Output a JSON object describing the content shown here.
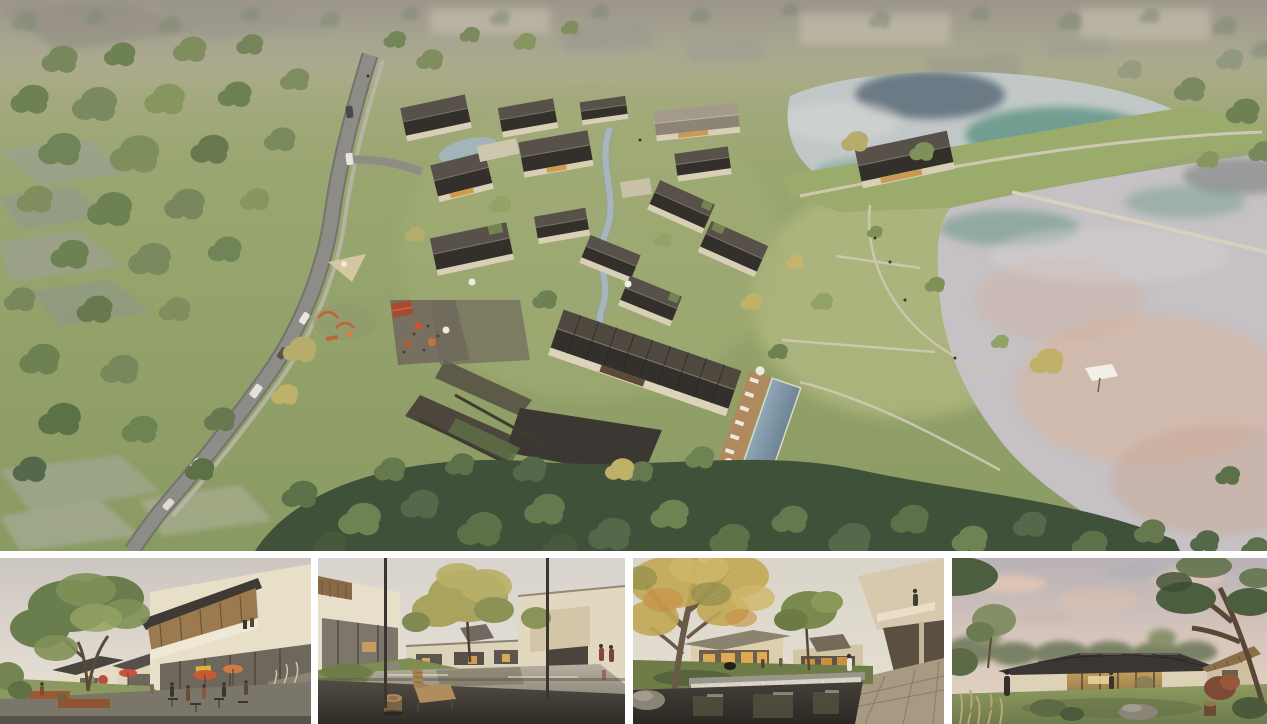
{
  "board": {
    "kind": "architectural rendering presentation board",
    "background_color": "#ffffff",
    "text_visible": "none"
  },
  "aerial_view": {
    "description": "Bird's-eye rendering of a courtyard-house resort village beside two ponds, with a curved access road, meadows, dense tree belts and hazy fields at the horizon",
    "features": {
      "road": "curved grey access road with cars and a sidewalk",
      "village": "cluster of gabled courtyard houses with a central stream and stone terraces",
      "pool": "rectangular swimming pool with timber deck, white loungers and umbrellas",
      "cafe_terrace": "outdoor cafe terrace with orange umbrellas and a red-roofed kiosk",
      "playground": "children's playground with orange play equipment and a shade sail",
      "upper_pond": "upper pond with teal and dark tree reflections",
      "lower_pond": "lower pond with pink sunset reflections and a diagonal weir path",
      "berm": "grass dam with a footpath separating the two ponds",
      "context": "ghosted buildings and faded field plots at the top edge"
    },
    "palette": {
      "haze": "#a49e90",
      "meadow": "#93a26a",
      "lawn": "#b2ba82",
      "tree_dark": "#3f5138",
      "tree_mid": "#6d8152",
      "tree_light": "#93a368",
      "tree_autumn": "#c0b169",
      "road": "#8d8c86",
      "roof_dark": "#332f2a",
      "roof_mid": "#57514a",
      "wall": "#d9cfb6",
      "stone": "#4c463c",
      "pool": "#7e95a7",
      "deck": "#b08a5e",
      "stream": "#a7b6bc",
      "upper_pond_water": "#c2c8c8",
      "upper_pond_teal": "#5f9484",
      "lower_pond_water": "#c5c1c4",
      "lower_pond_peach": "#d8b49c",
      "path": "#cfc7b2"
    }
  },
  "thumbnails": [
    {
      "id": "street-cafe",
      "description": "Street-level view of two-storey shops with cafe terrace, orange umbrellas, people and a large tree"
    },
    {
      "id": "courtyard-pond",
      "description": "Courtyard reflecting pond framed by porch columns, with timber lounge chair and carved stump table"
    },
    {
      "id": "water-court",
      "description": "Water court with waterfall weir, large autumn tree and cantilevered balcony with a visitor"
    },
    {
      "id": "lakeside-pavilion",
      "description": "Single-storey glass pavilion with dark hipped roof glowing at dusk among trees and lawns"
    }
  ]
}
